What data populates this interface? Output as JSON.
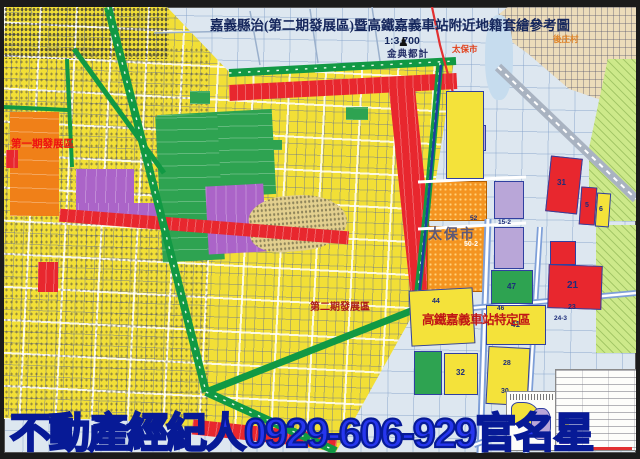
{
  "title": {
    "text": "嘉義縣治(第二期發展區)暨高鐵嘉義車站附近地籍套繪參考圖",
    "scale": "1:3,700"
  },
  "publisher": {
    "logo_icon": "♟",
    "name": "金典都計"
  },
  "map_labels": {
    "phase1_zone": "第一期發展區",
    "phase2_zone": "第二期發展區",
    "hsr_zone": "高鐵嘉義車站特定區",
    "taibao_city_small": "太保市",
    "taibao_city_large": "太保市",
    "village_ne": "後庄村"
  },
  "parcels": [
    {
      "label": "21"
    },
    {
      "label": "31"
    },
    {
      "label": "5"
    },
    {
      "label": "6"
    },
    {
      "label": "47"
    },
    {
      "label": "41"
    },
    {
      "label": "44"
    },
    {
      "label": "46"
    },
    {
      "label": "28"
    },
    {
      "label": "30"
    },
    {
      "label": "32"
    },
    {
      "label": "50-2"
    },
    {
      "label": "52"
    },
    {
      "label": "15-2"
    },
    {
      "label": "23"
    },
    {
      "label": "24-3"
    }
  ],
  "banner": {
    "text": "不動產經紀人0929-606-929官名星"
  },
  "colors": {
    "residential_yellow": "#f2df36",
    "commercial_red": "#e8272e",
    "park_green": "#2ea351",
    "school_purple": "#ab64c8",
    "phase1_orange": "#f08018",
    "industry_orange_dotted": "#f49420",
    "ring_road_green": "#119944",
    "water_blue": "#c6dcee",
    "banner_blue": "#2636ee"
  }
}
